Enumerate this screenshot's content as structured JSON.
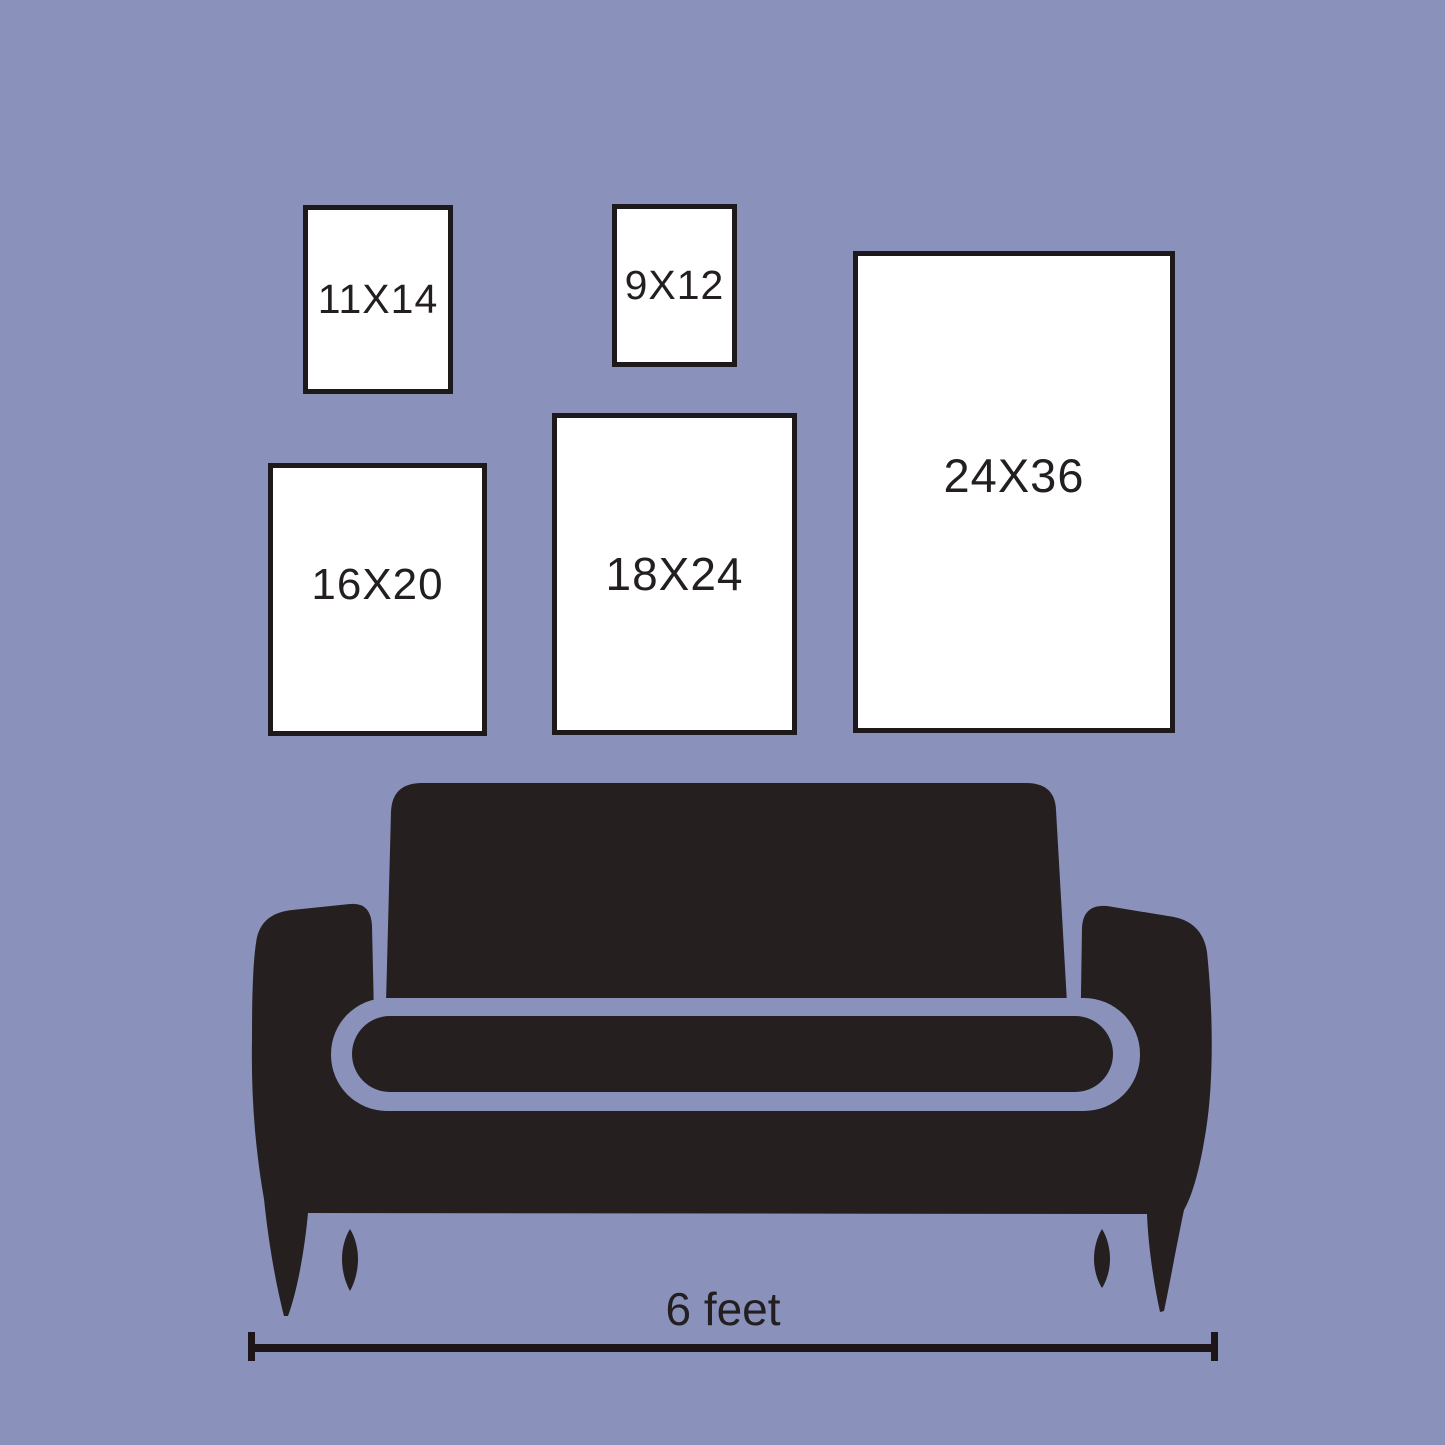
{
  "frames": [
    {
      "id": "11x14",
      "label": "11X14"
    },
    {
      "id": "9x12",
      "label": "9X12"
    },
    {
      "id": "16x20",
      "label": "16X20"
    },
    {
      "id": "18x24",
      "label": "18X24"
    },
    {
      "id": "24x36",
      "label": "24X36"
    }
  ],
  "measurement": {
    "label": "6 feet"
  },
  "colors": {
    "background": "#8A92BB",
    "frame_fill": "#FFFFFF",
    "frame_border": "#1E191A",
    "couch": "#251F20",
    "text": "#231F20",
    "line": "#1E1519"
  }
}
